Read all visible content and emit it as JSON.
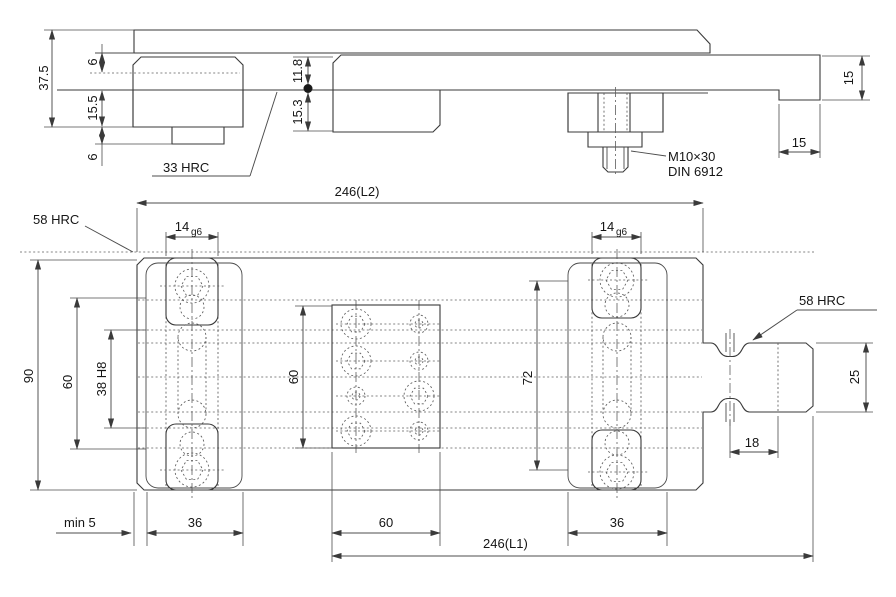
{
  "drawing": {
    "section_view": {
      "dim_37_5": "37.5",
      "dim_6_top": "6",
      "dim_15_5": "15.5",
      "dim_6_bottom": "6",
      "dim_11_8": "11.8",
      "dim_15_3": "15.3",
      "hardness_label": "33 HRC",
      "screw_spec": "M10×30",
      "screw_standard": "DIN 6912",
      "dim_15_right_height": "15",
      "dim_15_right_offset": "15"
    },
    "plan_view": {
      "dim_length_l2": "246(L2)",
      "hardness_left": "58 HRC",
      "hardness_right": "58 HRC",
      "slot_left_value": "14",
      "slot_left_fit": "g6",
      "slot_right_value": "14",
      "slot_right_fit": "g6",
      "dim_width_90": "90",
      "dim_60_left": "60",
      "dim_38h8": "38 H8",
      "dim_60_center": "60",
      "dim_72": "72",
      "dim_25": "25",
      "dim_18": "18",
      "dim_min5": "min 5",
      "dim_36_left": "36",
      "dim_60_bottom": "60",
      "dim_length_l1": "246(L1)",
      "dim_36_right": "36"
    }
  }
}
